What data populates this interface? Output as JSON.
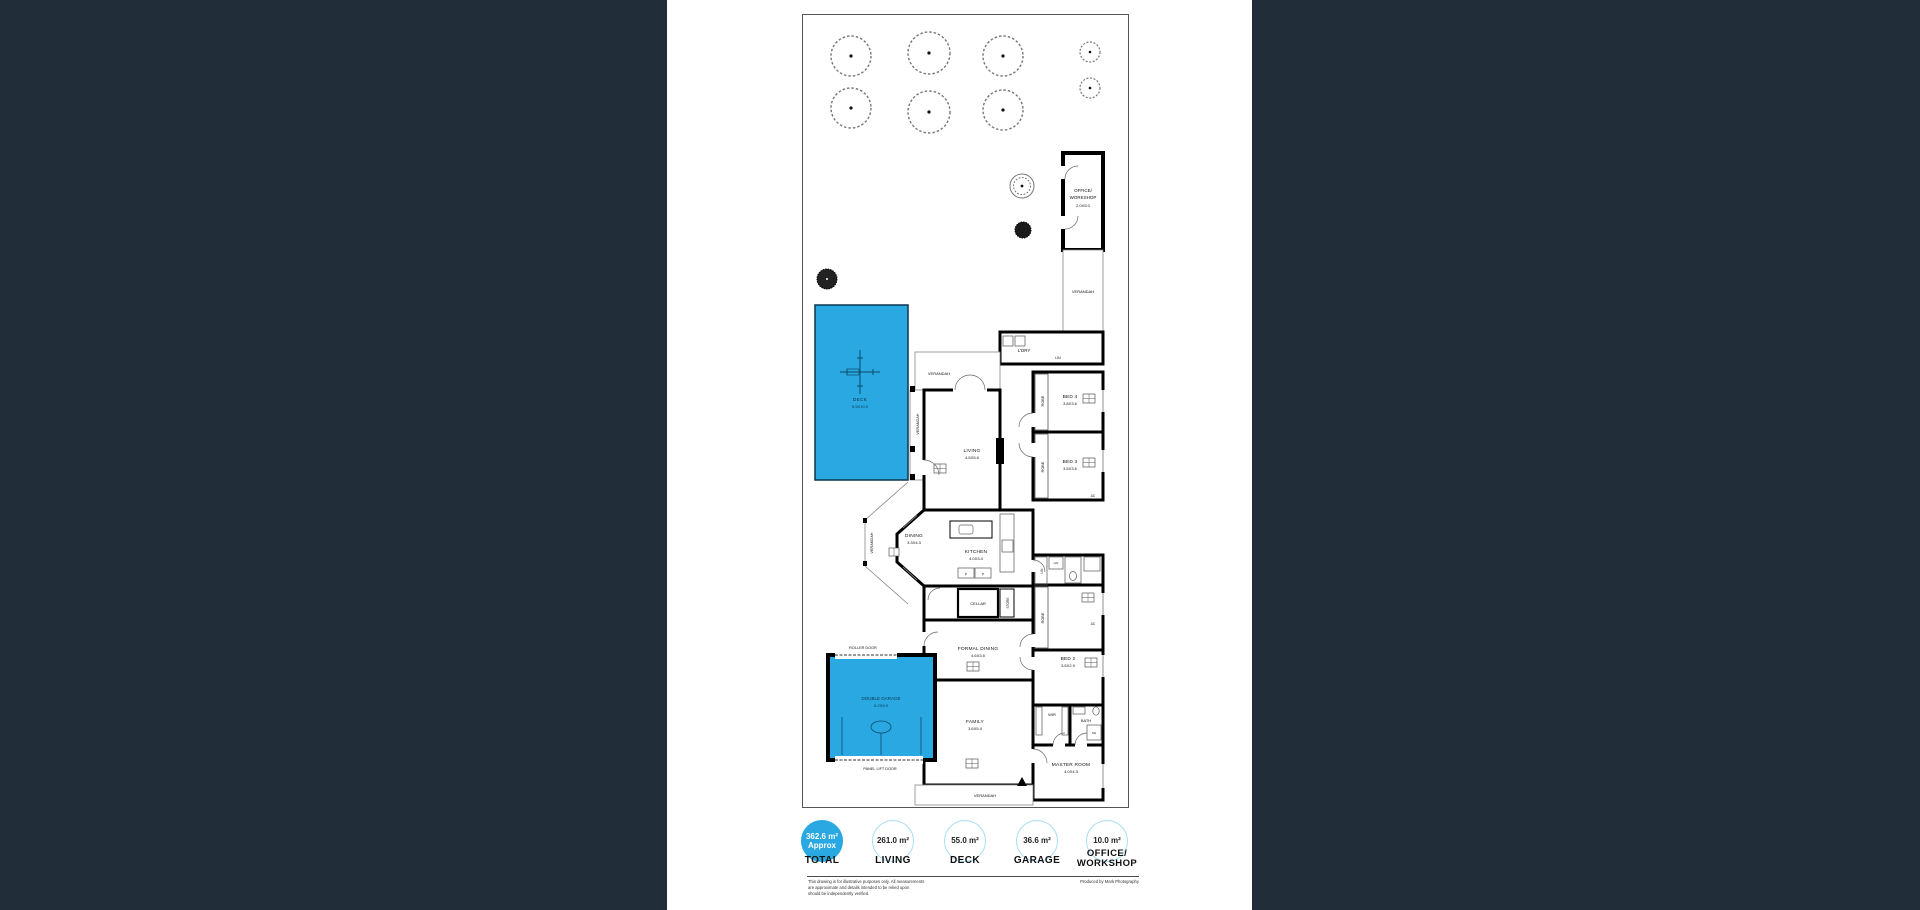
{
  "colors": {
    "background": "#212d38",
    "paper": "#ffffff",
    "accent_blue": "#29a8e1",
    "badge_ring": "#a8dff2"
  },
  "plan": {
    "rooms": {
      "office": {
        "line1": "OFFICE/",
        "line2": "WORKSHOP",
        "dims": "2.0X5.0"
      },
      "bed4": {
        "name": "BED 4",
        "dims": "3.8X3.6"
      },
      "bed3": {
        "name": "BED 3",
        "dims": "3.5X3.6"
      },
      "bed2": {
        "name": "BED 2",
        "dims": "3.5X2.9"
      },
      "living": {
        "name": "LIVING",
        "dims": "4.5X5.6"
      },
      "dining": {
        "name": "DINING",
        "dims": "3.3X4.3"
      },
      "kitchen": {
        "name": "KITCHEN",
        "dims": "4.0X3.4"
      },
      "formal_dining": {
        "name": "FORMAL DINING",
        "dims": "4.6X3.5"
      },
      "family": {
        "name": "FAMILY",
        "dims": "3.6X5.4"
      },
      "master": {
        "name": "MASTER ROOM",
        "dims": "4.0X4.3"
      },
      "deck": {
        "name": "DECK",
        "dims": "5.5X10.0"
      },
      "garage": {
        "name": "DOUBLE GARAGE",
        "dims": "6.2X5.9"
      }
    },
    "labels": {
      "verandah": "VERANDAH",
      "robe": "ROBE",
      "lin": "LIN",
      "ldry": "L'DRY",
      "cellar": "CELLAR",
      "store": "STORE",
      "wir": "WIR",
      "bath": "BATH",
      "sh": "SH",
      "ac": "AC",
      "dw": "DW",
      "p": "P",
      "roller_door": "ROLLER DOOR",
      "panel_lift_door": "PANEL LIFT DOOR"
    }
  },
  "summary": {
    "badges": [
      {
        "value": "362.6 m²",
        "qualifier": "Approx",
        "label": "TOTAL"
      },
      {
        "value": "261.0 m²",
        "label": "LIVING"
      },
      {
        "value": "55.0 m²",
        "label": "DECK"
      },
      {
        "value": "36.6 m²",
        "label": "GARAGE"
      },
      {
        "value": "10.0 m²",
        "label_line1": "OFFICE/",
        "label_line2": "WORKSHOP"
      }
    ],
    "disclaimer": "This drawing is for illustrative purposes only. All measurements\nare approximate and details intended to be relied upon\nshould be independently verified.",
    "credit": "Produced by Mark Photography"
  }
}
